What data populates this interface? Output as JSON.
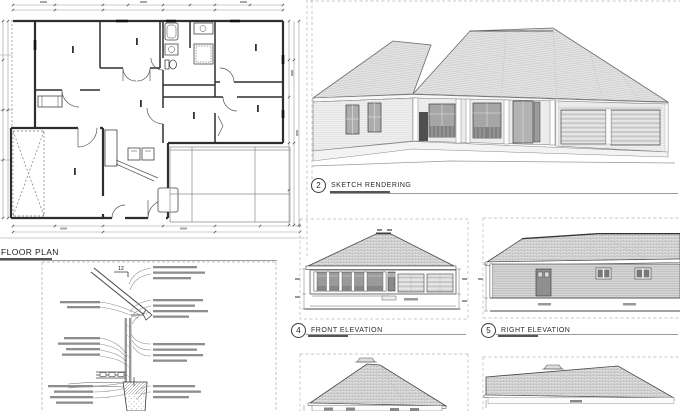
{
  "colors": {
    "background": "#ffffff",
    "line": "#3a3a3a",
    "annotation_bar": "#8d8d8d",
    "roof_fill": "#dedede"
  },
  "panels": {
    "floor_plan": {
      "label": "FLOOR PLAN"
    },
    "sketch_rendering": {
      "number": "2",
      "label": "SKETCH RENDERING"
    },
    "wall_section": {
      "slope_value": "12"
    },
    "front_elevation": {
      "number": "4",
      "label": "FRONT ELEVATION"
    },
    "right_elevation": {
      "number": "5",
      "label": "RIGHT ELEVATION"
    }
  }
}
